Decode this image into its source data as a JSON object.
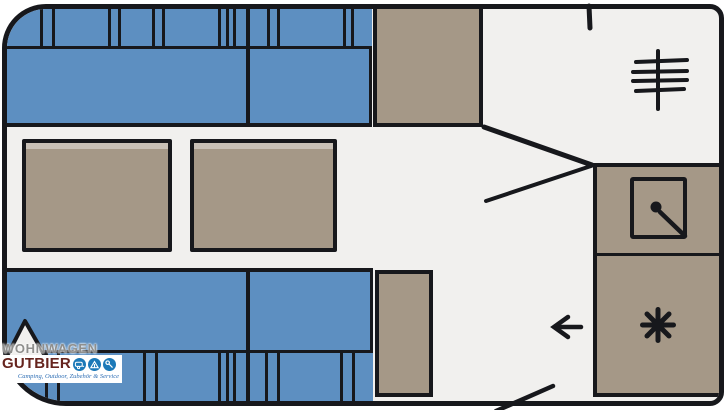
{
  "document": {
    "type": "caravan-floorplan-diagram",
    "description": "Top-view floor plan of a caravan interior"
  },
  "logo": {
    "brand_top": "WOHNWAGEN",
    "brand_main": "GUTBIER",
    "tagline": "Camping, Outdoor, Zubehör & Service",
    "icons": [
      "caravan-icon",
      "tent-icon",
      "wrench-icon"
    ]
  },
  "floorplan": {
    "furniture": [
      "front-bench-backrest",
      "front-bench-seat",
      "wardrobe",
      "table-left",
      "table-right",
      "rear-bench-seat",
      "rear-bench-backrest",
      "rear-cabinet",
      "kitchen-counter",
      "sink",
      "hob-burner"
    ],
    "icons": [
      "heater-icon",
      "sink-faucet-icon",
      "burner-icon",
      "entrance-arrow-icon",
      "door-swing-line"
    ],
    "colors": {
      "seat_blue": "#5d8fc1",
      "furniture_tan": "#a59887",
      "floor": "#f1f0ee",
      "outline": "#17181c",
      "logo_gray": "#8f8f8d",
      "logo_red": "#66241e",
      "logo_blue": "#1c79b8",
      "tagline_blue": "#2f6fb5"
    }
  }
}
